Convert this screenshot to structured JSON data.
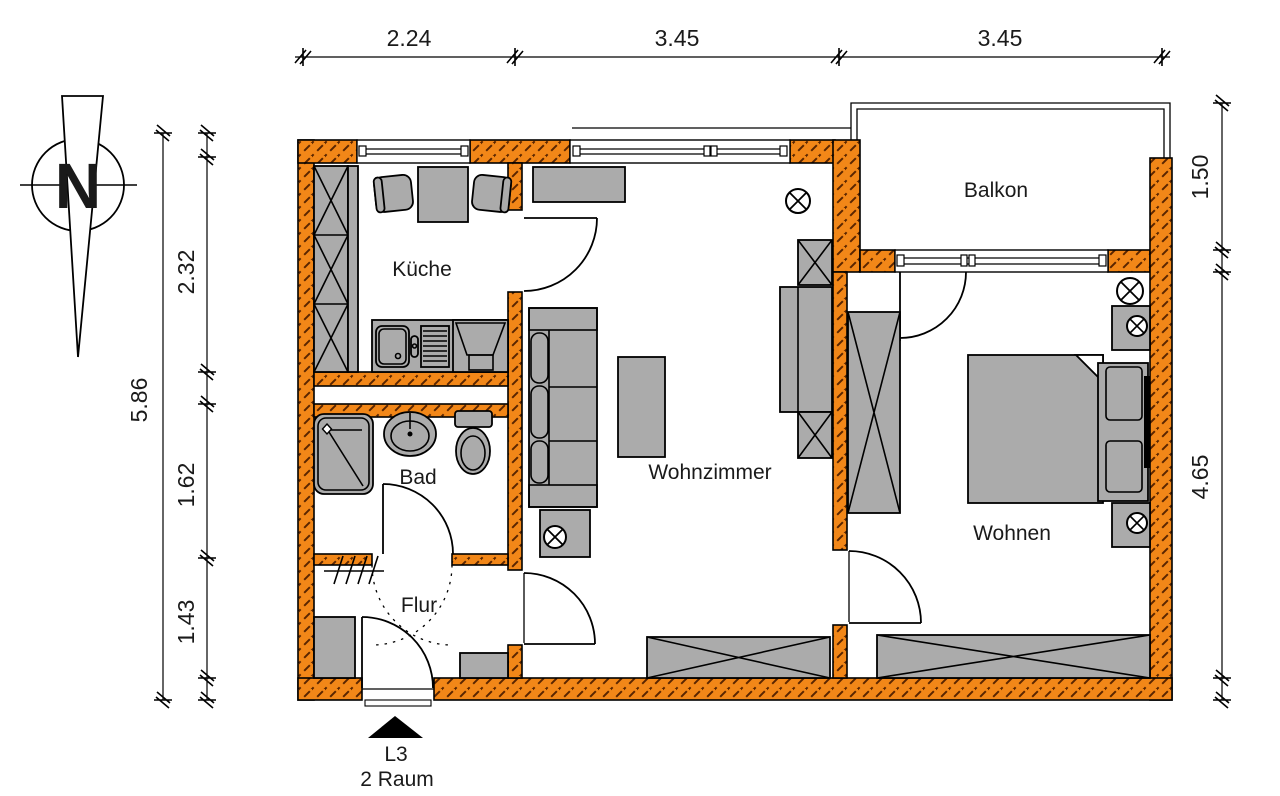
{
  "compass": {
    "north_label": "N"
  },
  "dimensions": {
    "top": [
      "2.24",
      "3.45",
      "3.45"
    ],
    "left_total": "5.86",
    "left": [
      "2.32",
      "1.62",
      "1.43"
    ],
    "right": [
      "1.50",
      "4.65"
    ]
  },
  "rooms": {
    "kitchen": "Küche",
    "bathroom": "Bad",
    "hallway": "Flur",
    "living_room": "Wohnzimmer",
    "bedroom": "Wohnen",
    "balcony": "Balkon"
  },
  "entrance": {
    "position_label": "L3",
    "type_label": "2 Raum"
  },
  "colors": {
    "wall_fill": "#F28718",
    "wall_hatch": "#5A2500",
    "furniture": "#ABABAB",
    "line": "#000000"
  }
}
